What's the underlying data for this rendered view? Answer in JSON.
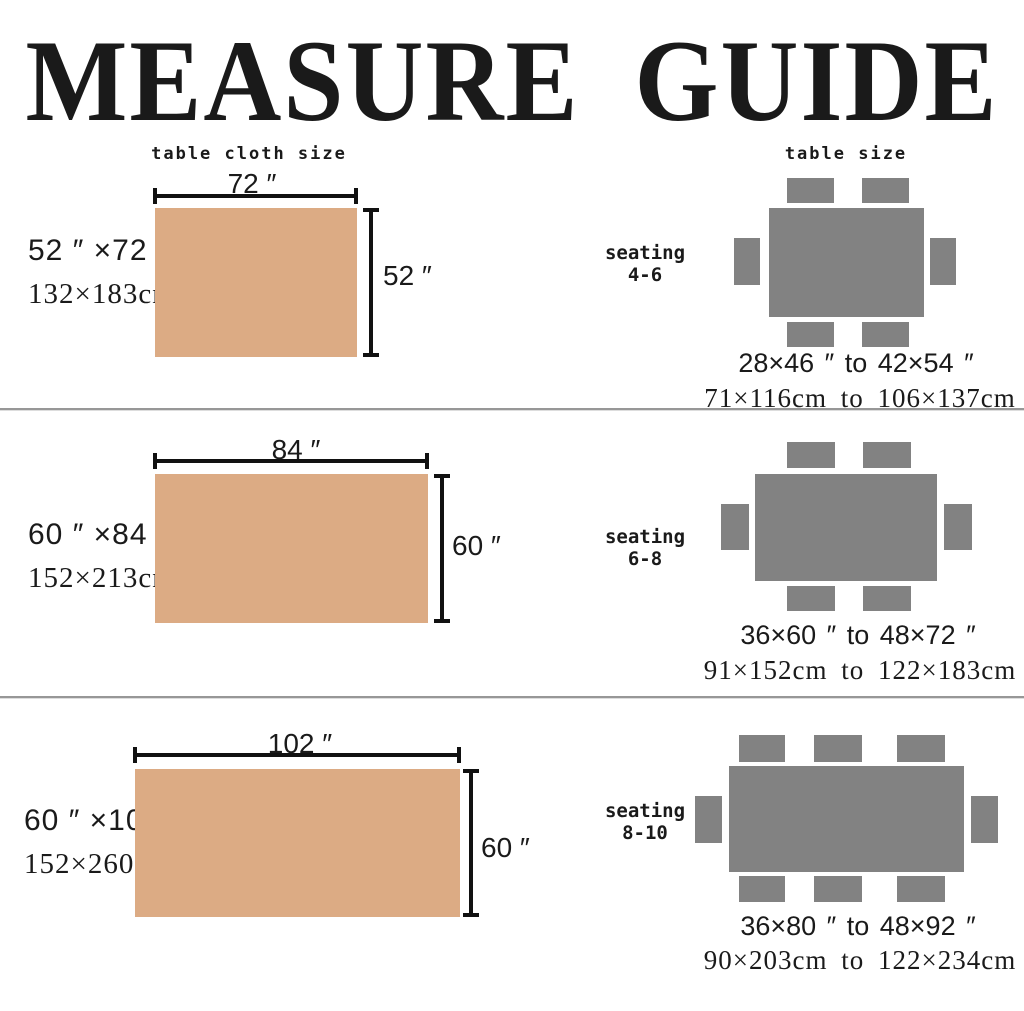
{
  "title": "MEASURE GUIDE",
  "columns": {
    "left": "table cloth size",
    "right": "table size"
  },
  "colors": {
    "ink": "#1a1a1a",
    "cloth": "#dcab84",
    "table_gray": "#828282",
    "divider": "#979797"
  },
  "rows": [
    {
      "cloth": {
        "size_in": "52 ″ ×72 ″",
        "size_cm": "132×183cm",
        "width_dim": "72 ″",
        "height_dim": "52 ″"
      },
      "seating": {
        "label": "seating",
        "range": "4-6"
      },
      "table": {
        "chairs": 6,
        "size_range_in": "28×46 ″ to 42×54 ″",
        "size_range_cm": "71×116cm to 106×137cm"
      }
    },
    {
      "cloth": {
        "size_in": "60 ″ ×84 ″",
        "size_cm": "152×213cm",
        "width_dim": "84 ″",
        "height_dim": "60 ″"
      },
      "seating": {
        "label": "seating",
        "range": "6-8"
      },
      "table": {
        "chairs": 6,
        "size_range_in": "36×60 ″  to 48×72 ″",
        "size_range_cm": "91×152cm to 122×183cm"
      }
    },
    {
      "cloth": {
        "size_in": "60 ″ ×102 ″",
        "size_cm": "152×260cm",
        "width_dim": "102 ″",
        "height_dim": "60 ″"
      },
      "seating": {
        "label": "seating",
        "range": "8-10"
      },
      "table": {
        "chairs": 8,
        "size_range_in": "36×80 ″  to 48×92 ″",
        "size_range_cm": "90×203cm to 122×234cm"
      }
    }
  ]
}
